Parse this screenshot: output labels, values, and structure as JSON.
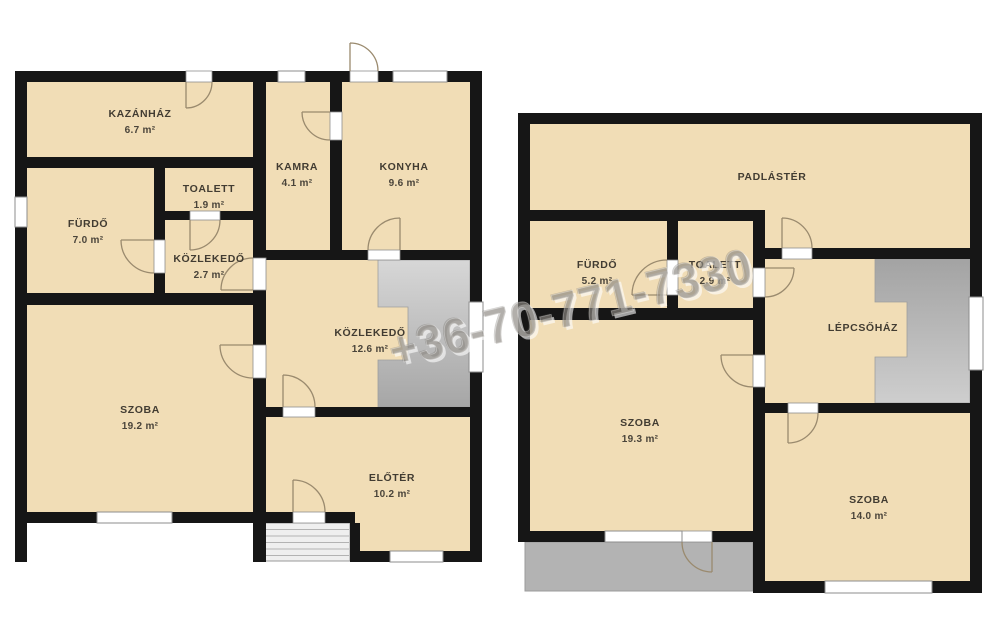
{
  "watermark": "+36-70-771-7330",
  "ground": {
    "rooms": [
      {
        "id": "kazanhaz",
        "name": "KAZÁNHÁZ",
        "area": "6.7 m²"
      },
      {
        "id": "toalett",
        "name": "TOALETT",
        "area": "1.9 m²"
      },
      {
        "id": "furdo",
        "name": "FÜRDŐ",
        "area": "7.0 m²"
      },
      {
        "id": "kozlekedo-small",
        "name": "KÖZLEKEDŐ",
        "area": "2.7 m²"
      },
      {
        "id": "kamra",
        "name": "KAMRA",
        "area": "4.1 m²"
      },
      {
        "id": "konyha",
        "name": "KONYHA",
        "area": "9.6 m²"
      },
      {
        "id": "kozlekedo-large",
        "name": "KÖZLEKEDŐ",
        "area": "12.6 m²"
      },
      {
        "id": "szoba",
        "name": "SZOBA",
        "area": "19.2 m²"
      },
      {
        "id": "eloter",
        "name": "ELŐTÉR",
        "area": "10.2 m²"
      }
    ]
  },
  "upper": {
    "rooms": [
      {
        "id": "padlaster",
        "name": "PADLÁSTÉR",
        "area": ""
      },
      {
        "id": "furdo",
        "name": "FÜRDŐ",
        "area": "5.2 m²"
      },
      {
        "id": "toalett",
        "name": "TOALETT",
        "area": "2.9 m²"
      },
      {
        "id": "lepcsohaz",
        "name": "LÉPCSŐHÁZ",
        "area": ""
      },
      {
        "id": "szoba-1",
        "name": "SZOBA",
        "area": "19.3 m²"
      },
      {
        "id": "szoba-2",
        "name": "SZOBA",
        "area": "14.0 m²"
      }
    ]
  },
  "colors": {
    "floor": "#f1ddb6",
    "wall": "#161616",
    "stair_light": "#d2d2d2",
    "stair_dark": "#a8a8a8",
    "terrace": "#b3b3b3",
    "label": "#423c32"
  }
}
